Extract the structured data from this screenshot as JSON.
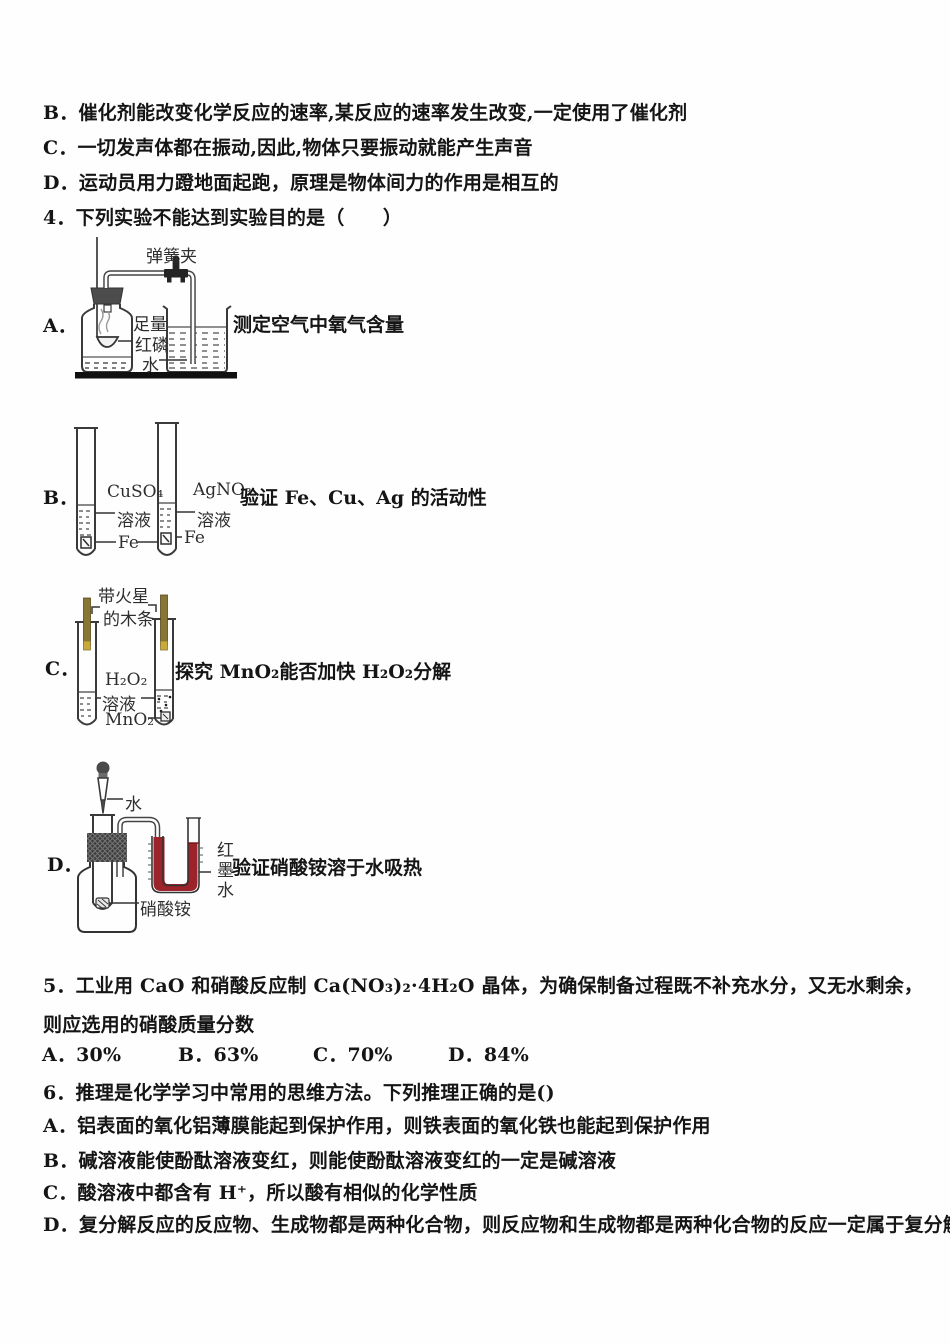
{
  "colors": {
    "red_ink": "#9b2329",
    "wood_splint": "#8a7634",
    "stopper_gray": "#3d3d3d"
  },
  "q3": {
    "option_b": "B．催化剂能改变化学反应的速率,某反应的速率发生改变,一定使用了催化剂",
    "option_c": "C．一切发声体都在振动,因此,物体只要振动就能产生声音",
    "option_d": "D．运动员用力蹬地面起跑，原理是物体间力的作用是相互的"
  },
  "q4": {
    "stem": "4．下列实验不能达到实验目的是（　　）",
    "items": [
      {
        "letter": "A．",
        "caption": "测定空气中氧气含量",
        "labels": {
          "clamp": "弹簧夹",
          "amount": "足量",
          "substance": "红磷",
          "water": "水"
        }
      },
      {
        "letter": "B．",
        "caption": "验证 Fe、Cu、Ag 的活动性",
        "labels": {
          "left_top": "CuSO₄",
          "left_bottom": "溶液",
          "left_metal": "Fe",
          "right_top": "AgNO₃",
          "right_bottom": "溶液",
          "right_metal": "Fe"
        }
      },
      {
        "letter": "C．",
        "caption": "探究 MnO₂能否加快 H₂O₂分解",
        "labels": {
          "splint_line1": "带火星",
          "splint_line2": "的木条",
          "peroxide": "H₂O₂",
          "solution": "溶液",
          "catalyst": "MnO₂"
        }
      },
      {
        "letter": "D．",
        "caption": "验证硝酸铵溶于水吸热",
        "labels": {
          "water": "水",
          "salt": "硝酸铵",
          "red_ink": "红墨水"
        }
      }
    ]
  },
  "q5": {
    "stem": "5．工业用 CaO 和硝酸反应制 Ca(NO₃)₂·4H₂O 晶体，为确保制备过程既不补充水分，又无水剩余，则应选用的硝酸质量分数",
    "options": [
      "A．30%",
      "B．63%",
      "C．70%",
      "D．84%"
    ]
  },
  "q6": {
    "stem": "6．推理是化学学习中常用的思维方法。下列推理正确的是()",
    "options": [
      "A．铝表面的氧化铝薄膜能起到保护作用，则铁表面的氧化铁也能起到保护作用",
      "B．碱溶液能使酚酞溶液变红，则能使酚酞溶液变红的一定是碱溶液",
      "C．酸溶液中都含有 H⁺，所以酸有相似的化学性质",
      "D．复分解反应的反应物、生成物都是两种化合物，则反应物和生成物都是两种化合物的反应一定属于复分解反应"
    ]
  }
}
